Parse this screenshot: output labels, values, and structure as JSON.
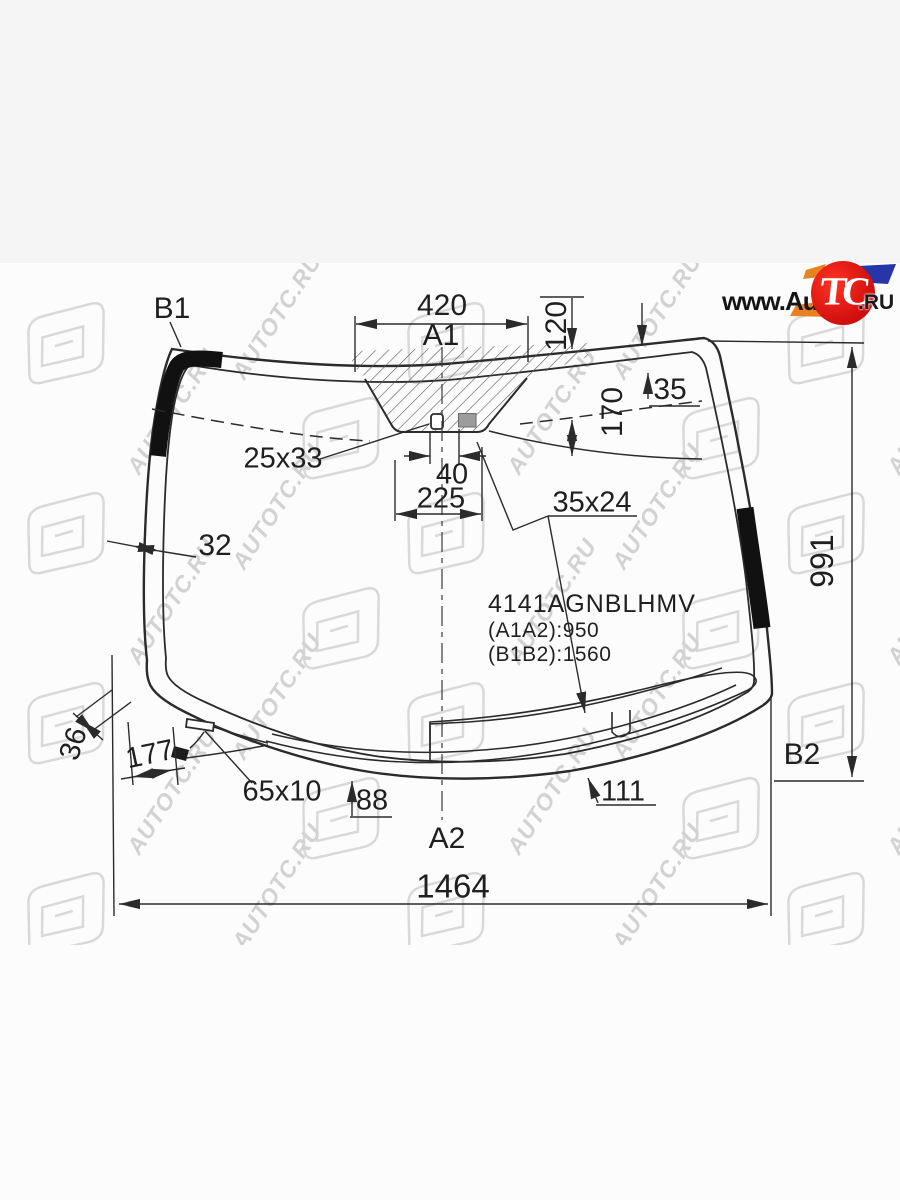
{
  "logo": {
    "prefix": "www.",
    "name": "Auto",
    "badge": "TC",
    "suffix": ".RU",
    "badge_color": "#d11111",
    "orange": "#e8821e",
    "blue": "#2636a8"
  },
  "part": {
    "number": "4141AGNBLHMV",
    "length_a": "(A1A2):950",
    "length_b": "(B1B2):1560"
  },
  "points": {
    "b1": "B1",
    "a1": "A1",
    "a2": "A2",
    "b2": "B2"
  },
  "dimensions": {
    "top_width": "420",
    "d120": "120",
    "d35": "35",
    "d170": "170",
    "sensor_25x33": "25x33",
    "d40": "40",
    "d225": "225",
    "sensor_35x24": "35x24",
    "side_band": "32",
    "height": "991",
    "bottom_band": "36",
    "d177": "177",
    "sensor_65x10": "65x10",
    "d88": "88",
    "d111": "111",
    "total_width": "1464"
  },
  "watermark": {
    "text": "AUTOTC.RU"
  }
}
